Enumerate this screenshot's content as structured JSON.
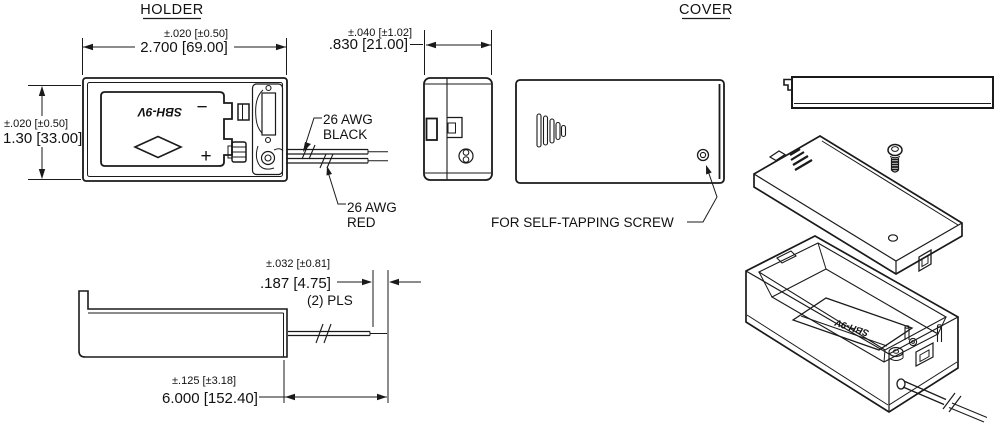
{
  "drawing": {
    "holder": {
      "title": "HOLDER",
      "front_view": {
        "width_tolerance": "±.020 [±0.50]",
        "width": "2.700 [69.00]",
        "height_tolerance": "±.020 [±0.50]",
        "height": "1.30 [33.00]",
        "battery_marking": "SBH-9V",
        "minus_sign": "−",
        "plus_sign": "+",
        "wire_black_line1": "26 AWG",
        "wire_black_line2": "BLACK",
        "wire_red_line1": "26 AWG",
        "wire_red_line2": "RED"
      },
      "side_view": {
        "depth_tolerance": "±.040 [±1.02]",
        "depth": ".830 [21.00]"
      },
      "profile_view": {
        "strip_tolerance": "±.032 [±0.81]",
        "strip_length": ".187 [4.75]",
        "strip_places": "(2) PLS",
        "wire_tolerance": "±.125 [±3.18]",
        "wire_length": "6.000 [152.40]"
      }
    },
    "cover": {
      "title": "COVER",
      "screw_note": "FOR SELF-TAPPING SCREW"
    },
    "iso": {
      "battery_marking": "SBH-9V"
    },
    "colors": {
      "line": "#1a1a1a",
      "background": "#ffffff"
    }
  }
}
